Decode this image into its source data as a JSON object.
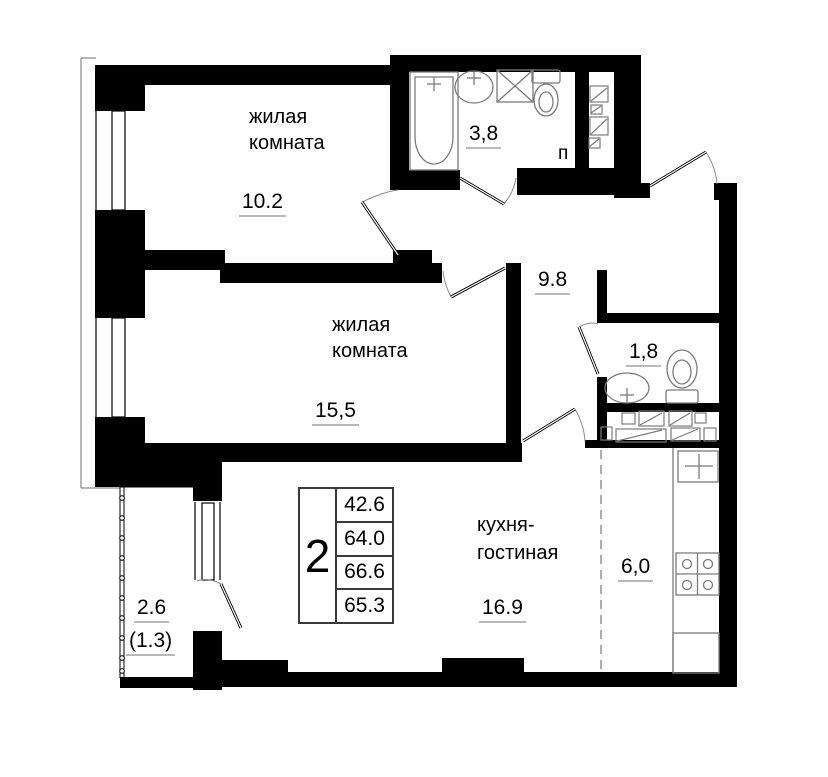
{
  "plan_title": "2-room apartment floor plan",
  "rooms": {
    "living1": {
      "name_line1": "жилая",
      "name_line2": "комната",
      "area": "10.2"
    },
    "living2": {
      "name_line1": "жилая",
      "name_line2": "комната",
      "area": "15,5"
    },
    "bathroom": {
      "area": "3,8"
    },
    "hallway": {
      "area": "9.8"
    },
    "wc": {
      "area": "1,8"
    },
    "kitchen_living": {
      "name_line1": "кухня-",
      "name_line2": "гостиная",
      "area": "16.9"
    },
    "kitchen_zone": {
      "area": "6,0"
    },
    "balcony": {
      "area": "2.6",
      "area_coef": "(1.3)"
    },
    "duct": {
      "label": "п"
    }
  },
  "info_table": {
    "rooms_count": "2",
    "areas": [
      "42.6",
      "64.0",
      "66.6",
      "65.3"
    ]
  },
  "colors": {
    "wall": "#000000",
    "fixture_line": "#7b7b7b",
    "underline": "#b9b9b9",
    "zone_dash": "#9a9a9a"
  }
}
